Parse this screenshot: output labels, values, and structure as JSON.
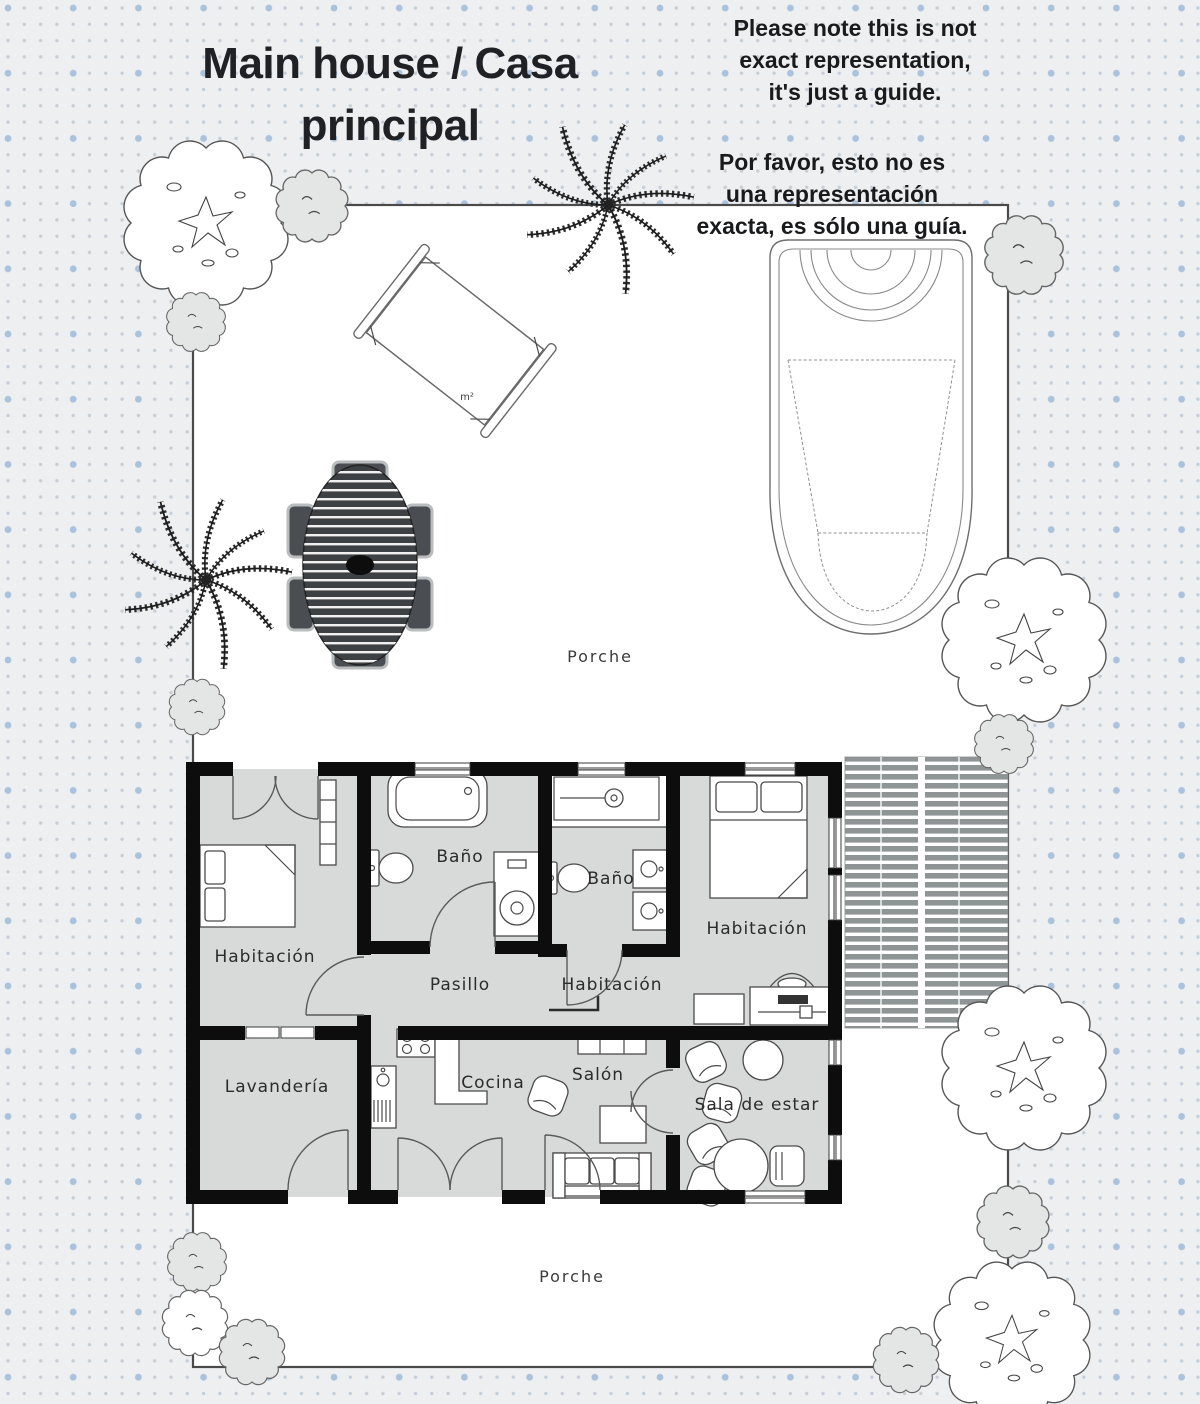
{
  "title": {
    "line1": "Main house / Casa",
    "line2": "principal"
  },
  "notes": {
    "en": [
      "Please note this is not",
      "exact representation,",
      "it's just a guide."
    ],
    "es": [
      "Por favor, esto no es",
      "una representación",
      "exacta, es sólo una guía."
    ]
  },
  "rooms": {
    "bedroom_left": "Habitación",
    "bath_1": "Baño",
    "bath_2": "Baño",
    "bedroom_right": "Habitación",
    "bedroom_middle": "Habitación",
    "hallway": "Pasillo",
    "laundry": "Lavandería",
    "kitchen": "Cocina",
    "living": "Salón",
    "sitting": "Sala de estar"
  },
  "outdoor": {
    "porch_top": "Porche",
    "porch_bottom": "Porche",
    "hammock_area": "m²"
  },
  "colors": {
    "background": "#edeff0",
    "dot_small": "#c5ced7",
    "dot_large": "#a9c2dd",
    "floor": "#d8dada",
    "wall": "#0d0d0d",
    "deck_slat": "#8f9595",
    "dining_dark": "#3e4144"
  }
}
